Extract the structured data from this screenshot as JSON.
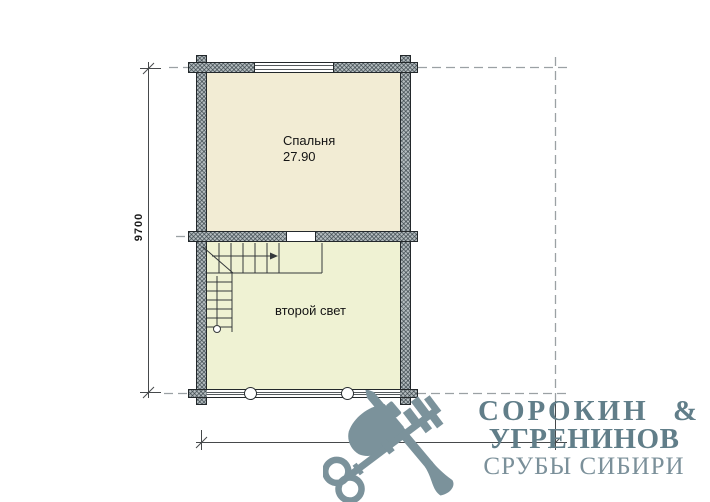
{
  "drawing": {
    "type": "floor-plan",
    "rooms": [
      {
        "name": "Спальня",
        "area": "27.90"
      },
      {
        "name": "второй свет"
      }
    ],
    "stairs": {
      "present": true,
      "direction_arrow": "right"
    },
    "dimensions": {
      "vertical": "9700",
      "horizontal": "10700"
    }
  },
  "logo": {
    "line1": "СОРОКИН &",
    "line2": "УГРЕНИНОВ",
    "line3": "СРУБЫ СИБИРИ",
    "mark": "axe-and-key-icon"
  },
  "colors": {
    "bedroom_fill": "#f2ecd4",
    "second_light_fill": "#eff2d3",
    "wall_fill": "#b4bcbf",
    "outline": "#23282b",
    "axis_line": "#9ba1a4",
    "logo_main": "#617e89",
    "logo_light": "#7b909a",
    "logo_mark": "#7b929b"
  }
}
